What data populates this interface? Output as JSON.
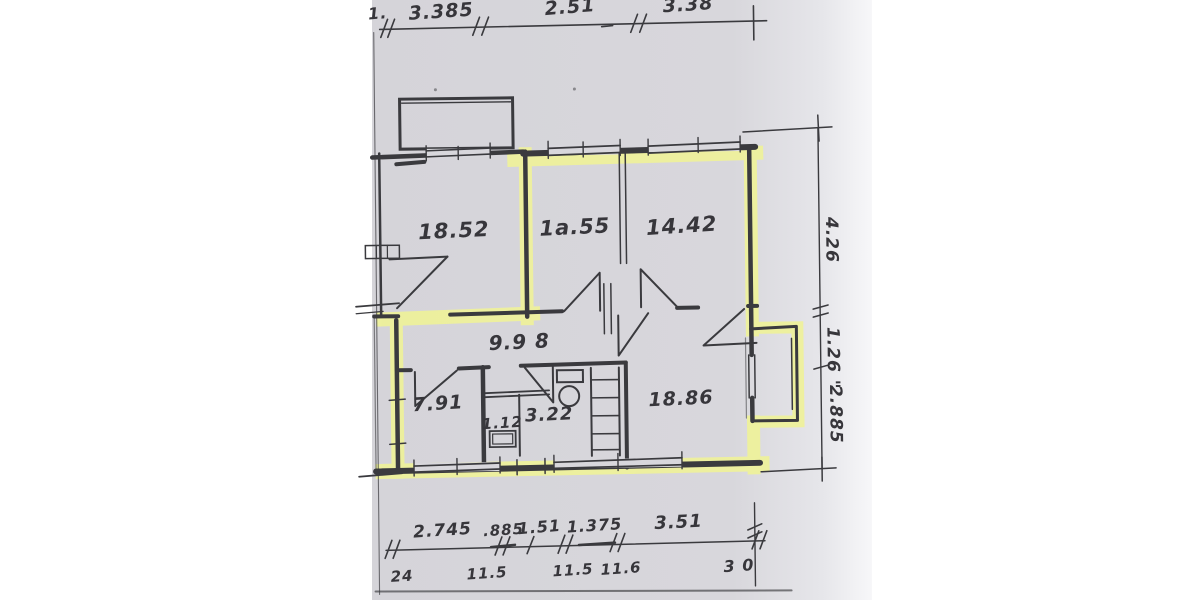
{
  "document_title": "Floor plan scan with highlighted apartment outline",
  "colors": {
    "paper": "#d8d7dc",
    "ink": "#3a3a3e",
    "highlighter": "#eff29a",
    "background": "#ffffff"
  },
  "rooms": [
    {
      "id": "room-top-left",
      "area": "18.52"
    },
    {
      "id": "room-top-middle",
      "area": "1a.55"
    },
    {
      "id": "room-top-right",
      "area": "14.42"
    },
    {
      "id": "hallway",
      "area": "9.9 8"
    },
    {
      "id": "room-bottom-left",
      "area": "7.91"
    },
    {
      "id": "wc",
      "area": "1.12"
    },
    {
      "id": "bathroom",
      "area": "3.22"
    },
    {
      "id": "room-bottom-right",
      "area": "18.86"
    }
  ],
  "dimensions": {
    "top": [
      "1.",
      "3.385",
      "2.51",
      "3.38"
    ],
    "right": [
      "4.26",
      "1.26 \"",
      "2.885"
    ],
    "bottom": [
      "2.745",
      ".885",
      "1.51",
      "1.375",
      "3.51"
    ],
    "wall_marks": [
      "24",
      "11.5",
      "11.5",
      "11.6",
      "3 0"
    ]
  }
}
